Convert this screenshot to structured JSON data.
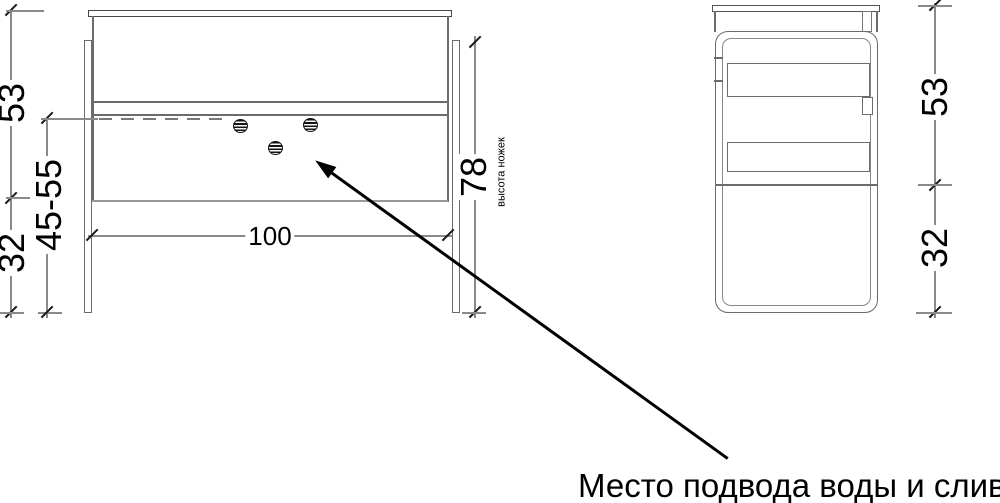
{
  "drawing": {
    "kind": "furniture technical drawing, front and side views with dimensions",
    "background": "#ffffff",
    "line_color": "#6b6b6b",
    "dim_line_color": "#8a8a8a",
    "text_color": "#000000"
  },
  "front_view": {
    "dimensions": {
      "upper_height": "53",
      "connection_height_range": "45-55",
      "lower_height": "32",
      "width": "100",
      "legs_height": "78",
      "legs_height_caption": "высота ножек"
    },
    "holes_count": 3
  },
  "side_view": {
    "dimensions": {
      "upper_height": "53",
      "lower_height": "32"
    }
  },
  "callout": {
    "text": "Место подвода воды и слив"
  }
}
